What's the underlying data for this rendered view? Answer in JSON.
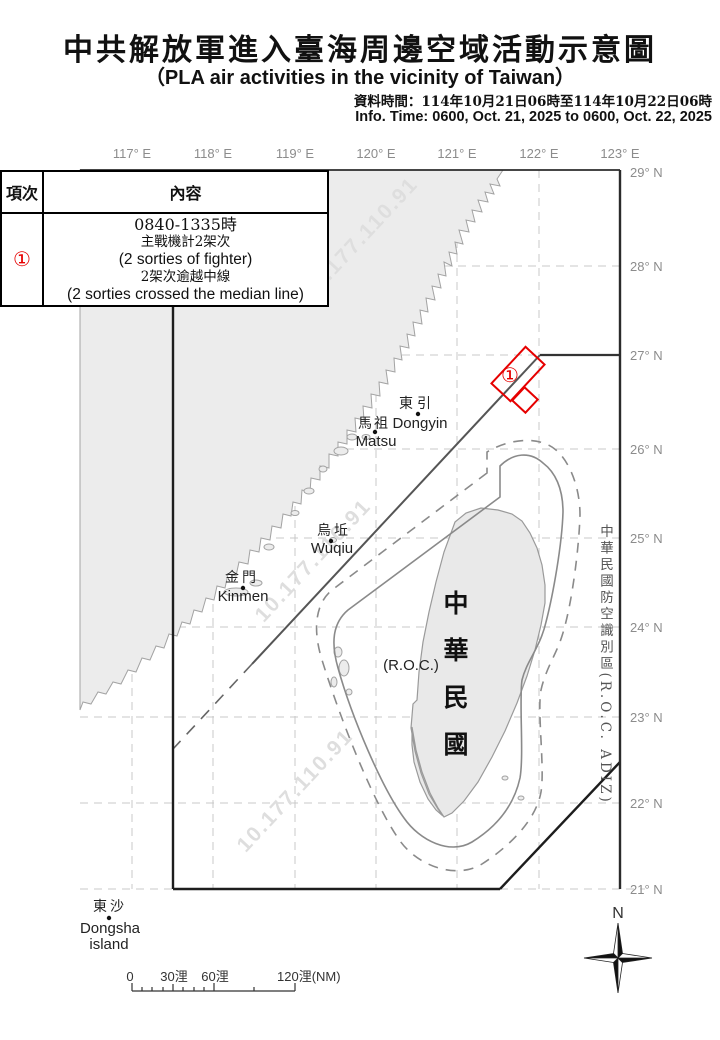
{
  "header": {
    "title_zh": "中共解放軍進入臺海周邊空域活動示意圖",
    "title_en": "（PLA air activities in the vicinity of Taiwan）",
    "data_time_zh": "資料時間：114年10月21日06時至114年10月22日06時",
    "info_time_en": "Info. Time: 0600, Oct. 21, 2025 to 0600, Oct. 22, 2025"
  },
  "table": {
    "col_item": "項次",
    "col_content": "內容",
    "row": {
      "item": "①",
      "line1": "0840-1335時",
      "line2": "主戰機計2架次",
      "line3": "(2 sorties of fighter)",
      "line4": "2架次逾越中線",
      "line5": "(2 sorties crossed the median line)"
    }
  },
  "map": {
    "lon_labels": [
      "117° E",
      "118° E",
      "119° E",
      "120° E",
      "121° E",
      "122° E",
      "123° E"
    ],
    "lat_labels": [
      "29° N",
      "28° N",
      "27° N",
      "26° N",
      "25° N",
      "24° N",
      "23° N",
      "22° N",
      "21° N"
    ],
    "places": {
      "dongyin_zh": "東引",
      "dongyin_en": "Dongyin",
      "matsu_zh": "馬祖",
      "matsu_en": "Matsu",
      "wuqiu_zh": "烏坵",
      "wuqiu_en": "Wuqiu",
      "kinmen_zh": "金門",
      "kinmen_en": "Kinmen",
      "dongsha_zh": "東沙",
      "dongsha_en": "Dongsha",
      "dongsha_en2": "island",
      "roc_zh": "中華民國",
      "roc_en": "(R.O.C.)"
    },
    "adiz_label": "中華民國防空識別區(R.O.C. ADIZ)",
    "marker_label": "①",
    "compass_label": "N",
    "scale": {
      "t0": "0",
      "t30": "30浬",
      "t60": "60浬",
      "t120": "120浬(NM)"
    },
    "watermark": "10.177.110.91",
    "colors": {
      "flight_red": "#e60000",
      "land_fill": "#ececec",
      "coast_stroke": "#a3a3a3",
      "grid": "#c9c9c9",
      "frame": "#2b2b2b",
      "median_line": "#555555",
      "contour": "#8a8a8a",
      "deg_label_gray": "#8c8c8c",
      "watermark_gray": "#dedede"
    }
  }
}
